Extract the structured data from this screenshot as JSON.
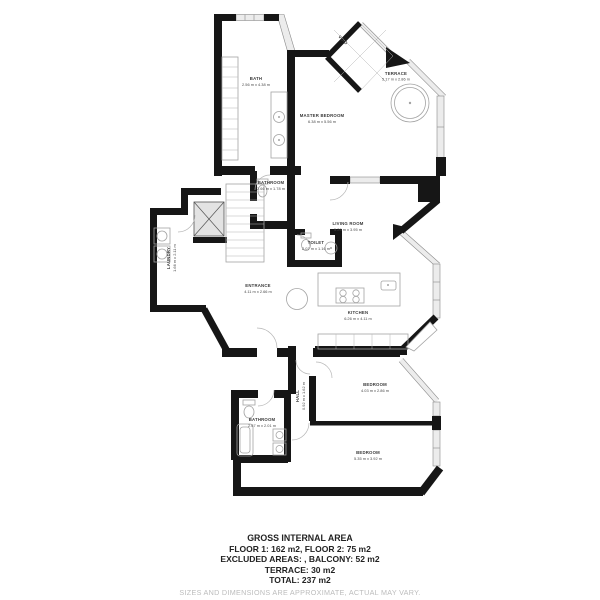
{
  "plan": {
    "colors": {
      "wall": "#161616",
      "window_fill": "#ececec",
      "window_edge": "#8a8a8a",
      "furniture": "#a3a3a3",
      "label_text": "#3a3a3a"
    },
    "rooms": [
      {
        "name": "BATH",
        "dims": "2.56 m x 4.38 m"
      },
      {
        "name": "MASTER BEDROOM",
        "dims": "6.38 m x 5.56 m"
      },
      {
        "name": "TERRACE",
        "dims": "5.17 m x 2.86 m"
      },
      {
        "name": "BATHROOM",
        "dims": "2.66 m x 1.78 m"
      },
      {
        "name": "TOILET",
        "dims": "2.07 m x 1.16 m"
      },
      {
        "name": "LAUNDRY",
        "dims": "1.66 m x 2.11 m"
      },
      {
        "name": "LIVING ROOM",
        "dims": "5.26 m x 3.95 m"
      },
      {
        "name": "ENTRANCE",
        "dims": "4.11 m x 2.66 m"
      },
      {
        "name": "KITCHEN",
        "dims": "6.26 m x 4.11 m"
      },
      {
        "name": "HALL",
        "dims": "0.92 m x 1.62 m"
      },
      {
        "name": "BEDROOM",
        "dims": "4.03 m x 2.86 m"
      },
      {
        "name": "BATHROOM",
        "dims": "2.67 m x 2.01 m"
      },
      {
        "name": "BEDROOM",
        "dims": "5.35 m x 3.92 m"
      },
      {
        "name": "VOID",
        "dims": ""
      }
    ]
  },
  "footer": {
    "title": "GROSS INTERNAL AREA",
    "lines": [
      "FLOOR 1: 162 m2, FLOOR 2: 75 m2",
      "EXCLUDED AREAS: , BALCONY: 52 m2",
      "TERRACE: 30 m2",
      "TOTAL: 237 m2"
    ],
    "disclaimer": "SIZES AND DIMENSIONS ARE APPROXIMATE, ACTUAL MAY VARY."
  }
}
